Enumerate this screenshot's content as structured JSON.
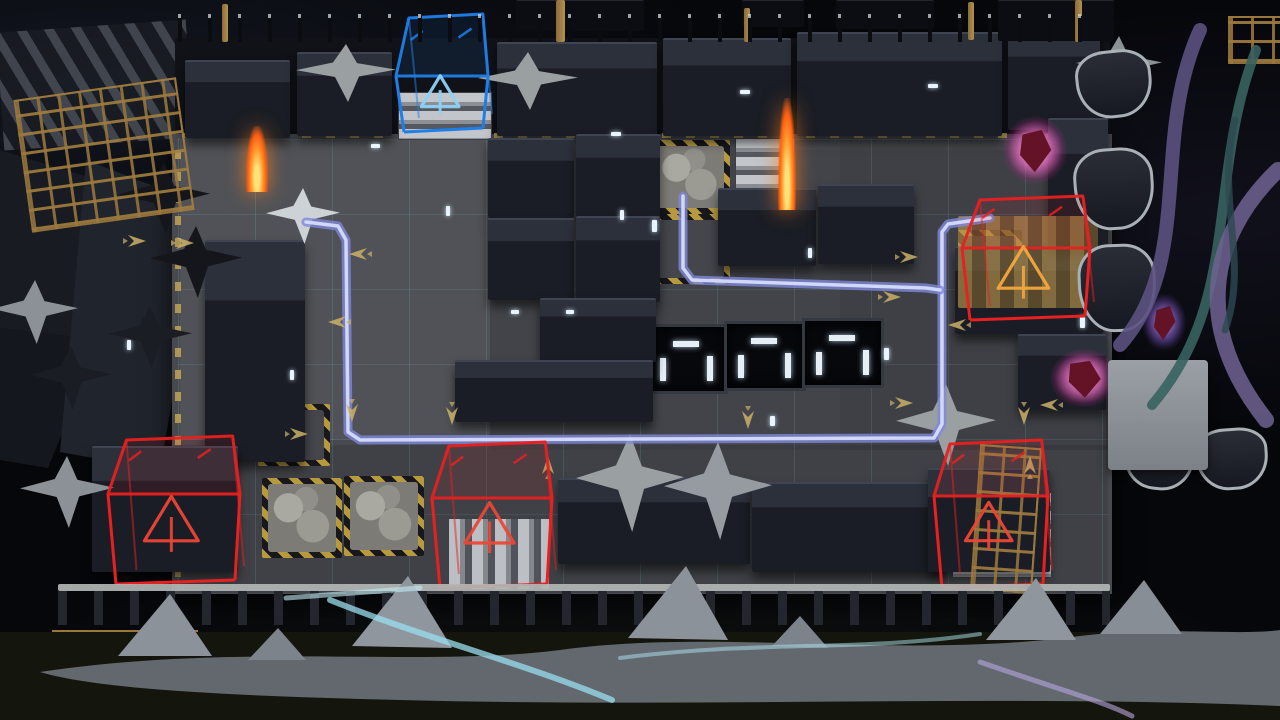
{
  "scene": {
    "description": "Tower-defense naval deck map preview with enemy spawn boxes, defense point and enemy route lines",
    "canvas": {
      "w": 1280,
      "h": 720
    }
  },
  "palette": {
    "water": "#06070b",
    "deck": "#47494f",
    "block_top": "#2c303b",
    "route_outer": "#7f88d8",
    "route_inner": "#d6dcfa",
    "spawn_red": "#e82020",
    "objective_blue": "#1f7fe8",
    "objective_icon": "#8fd2f8",
    "spawn_icon_orange": "#f2a83e",
    "spawn_icon_red": "#ee4636",
    "arrow_tan": "#cbb069",
    "hazard_yellow": "#b89a3e",
    "flame_orange": "#ff7a1a"
  },
  "board": {
    "x": 178,
    "y": 138,
    "w": 930,
    "h": 452,
    "cols": 12,
    "rows": 6
  },
  "objective": {
    "id": "defense-point",
    "x": 396,
    "y": 14,
    "w": 92,
    "h": 118,
    "th": 62,
    "color": "#1f7fe8",
    "icon_color": "#8fd2f8"
  },
  "spawns": [
    {
      "id": "spawn-northeast",
      "x": 962,
      "y": 196,
      "w": 128,
      "h": 124,
      "th": 52,
      "color": "#e82020",
      "icon_color": "#f2a83e"
    },
    {
      "id": "spawn-southwest",
      "x": 108,
      "y": 436,
      "w": 132,
      "h": 148,
      "th": 58,
      "color": "#e82020",
      "icon_color": "#ee4636"
    },
    {
      "id": "spawn-south",
      "x": 432,
      "y": 442,
      "w": 120,
      "h": 146,
      "th": 56,
      "color": "#e82020",
      "icon_color": "#ee4636"
    },
    {
      "id": "spawn-southeast",
      "x": 934,
      "y": 440,
      "w": 114,
      "h": 148,
      "th": 56,
      "color": "#e82020",
      "icon_color": "#ee4636"
    }
  ],
  "routes": [
    {
      "id": "route-main",
      "points": [
        [
          990,
          218
        ],
        [
          948,
          224
        ],
        [
          942,
          232
        ],
        [
          942,
          424
        ],
        [
          934,
          438
        ],
        [
          360,
          440
        ],
        [
          348,
          432
        ],
        [
          346,
          240
        ],
        [
          338,
          226
        ],
        [
          306,
          222
        ]
      ]
    },
    {
      "id": "route-branch",
      "points": [
        [
          683,
          196
        ],
        [
          683,
          268
        ],
        [
          692,
          280
        ],
        [
          926,
          288
        ],
        [
          940,
          290
        ]
      ]
    }
  ],
  "arrows": [
    [
      138,
      241,
      0
    ],
    [
      186,
      243,
      0
    ],
    [
      357,
      254,
      180
    ],
    [
      336,
      322,
      180
    ],
    [
      300,
      434,
      0
    ],
    [
      352,
      414,
      90
    ],
    [
      452,
      417,
      90
    ],
    [
      748,
      421,
      90
    ],
    [
      1024,
      417,
      90
    ],
    [
      548,
      464,
      -90
    ],
    [
      1030,
      464,
      -90
    ],
    [
      910,
      257,
      0
    ],
    [
      893,
      297,
      0
    ],
    [
      956,
      325,
      180
    ],
    [
      905,
      403,
      0
    ],
    [
      1048,
      405,
      180
    ]
  ],
  "blocks": [
    {
      "x": 185,
      "y": 60,
      "w": 105,
      "h": 76
    },
    {
      "x": 297,
      "y": 52,
      "w": 95,
      "h": 82
    },
    {
      "x": 497,
      "y": 42,
      "w": 160,
      "h": 92
    },
    {
      "x": 663,
      "y": 38,
      "w": 128,
      "h": 96
    },
    {
      "x": 797,
      "y": 32,
      "w": 205,
      "h": 102
    },
    {
      "x": 1008,
      "y": 28,
      "w": 92,
      "h": 100
    },
    {
      "x": 516,
      "y": 0,
      "w": 128,
      "h": 30,
      "s": "d2"
    },
    {
      "x": 742,
      "y": 0,
      "w": 62,
      "h": 26,
      "s": "d2"
    },
    {
      "x": 836,
      "y": 0,
      "w": 98,
      "h": 28,
      "s": "d2"
    },
    {
      "x": 998,
      "y": 0,
      "w": 116,
      "h": 40,
      "s": "d2"
    },
    {
      "x": 205,
      "y": 240,
      "w": 100,
      "h": 220
    },
    {
      "x": 488,
      "y": 138,
      "w": 86,
      "h": 78
    },
    {
      "x": 576,
      "y": 134,
      "w": 84,
      "h": 82
    },
    {
      "x": 488,
      "y": 218,
      "w": 86,
      "h": 80
    },
    {
      "x": 576,
      "y": 216,
      "w": 84,
      "h": 84
    },
    {
      "x": 718,
      "y": 188,
      "w": 98,
      "h": 76
    },
    {
      "x": 818,
      "y": 184,
      "w": 96,
      "h": 78
    },
    {
      "x": 540,
      "y": 298,
      "w": 116,
      "h": 62
    },
    {
      "x": 455,
      "y": 360,
      "w": 198,
      "h": 60
    },
    {
      "x": 955,
      "y": 246,
      "w": 148,
      "h": 86
    },
    {
      "x": 1018,
      "y": 334,
      "w": 88,
      "h": 74
    },
    {
      "x": 1048,
      "y": 118,
      "w": 60,
      "h": 128
    },
    {
      "x": 92,
      "y": 446,
      "w": 146,
      "h": 124
    },
    {
      "x": 558,
      "y": 478,
      "w": 192,
      "h": 84
    },
    {
      "x": 752,
      "y": 482,
      "w": 192,
      "h": 88
    },
    {
      "x": 928,
      "y": 468,
      "w": 122,
      "h": 102
    }
  ],
  "pits": [
    {
      "x": 646,
      "y": 324,
      "w": 76,
      "h": 64
    },
    {
      "x": 724,
      "y": 321,
      "w": 76,
      "h": 64
    },
    {
      "x": 802,
      "y": 318,
      "w": 76,
      "h": 64
    }
  ],
  "hazards_rubble": [
    {
      "x": 650,
      "y": 140,
      "w": 80,
      "h": 74
    },
    {
      "x": 262,
      "y": 478,
      "w": 80,
      "h": 80
    },
    {
      "x": 344,
      "y": 476,
      "w": 80,
      "h": 80
    }
  ],
  "hazards_outline": [
    {
      "x": 258,
      "y": 404,
      "w": 72,
      "h": 62
    },
    {
      "x": 652,
      "y": 214,
      "w": 78,
      "h": 70
    },
    {
      "x": 958,
      "y": 230,
      "w": 64,
      "h": 64
    }
  ],
  "stairs": [
    {
      "x": 398,
      "y": 92,
      "w": 92,
      "h": 46,
      "dir": "h"
    },
    {
      "x": 735,
      "y": 138,
      "w": 58,
      "h": 76,
      "dir": "h"
    },
    {
      "x": 448,
      "y": 518,
      "w": 100,
      "h": 70,
      "dir": "v"
    },
    {
      "x": 952,
      "y": 492,
      "w": 98,
      "h": 84,
      "dir": "h"
    },
    {
      "x": 150,
      "y": 472,
      "w": 82,
      "h": 96,
      "dir": "v"
    }
  ],
  "caltrops": [
    {
      "x": 296,
      "y": 44,
      "w": 100,
      "h": 58,
      "c": "#9aa0a2"
    },
    {
      "x": 478,
      "y": 52,
      "w": 100,
      "h": 58,
      "c": "#9aa0a2"
    },
    {
      "x": 266,
      "y": 188,
      "w": 74,
      "h": 56,
      "c": "#cdd2d6"
    },
    {
      "x": 576,
      "y": 434,
      "w": 108,
      "h": 98,
      "c": "#9aa0a2"
    },
    {
      "x": 664,
      "y": 442,
      "w": 108,
      "h": 98,
      "c": "#959ba0"
    },
    {
      "x": 896,
      "y": 384,
      "w": 100,
      "h": 82,
      "c": "#9aa0a2"
    },
    {
      "x": -8,
      "y": 280,
      "w": 86,
      "h": 64,
      "c": "#8b9196"
    },
    {
      "x": 20,
      "y": 456,
      "w": 94,
      "h": 72,
      "c": "#8b9196"
    },
    {
      "x": 1076,
      "y": 36,
      "w": 86,
      "h": 60,
      "c": "#8b9196"
    },
    {
      "x": 118,
      "y": 162,
      "w": 92,
      "h": 72,
      "c": "#14161c"
    },
    {
      "x": 150,
      "y": 226,
      "w": 92,
      "h": 72,
      "c": "#14161c"
    },
    {
      "x": 30,
      "y": 346,
      "w": 82,
      "h": 64,
      "c": "#1a1d23"
    },
    {
      "x": 108,
      "y": 306,
      "w": 84,
      "h": 62,
      "c": "#1a1d23"
    }
  ],
  "scaffolds": [
    {
      "x": 22,
      "y": 88,
      "w": 160,
      "h": 130,
      "rot": -8
    },
    {
      "x": 52,
      "y": 630,
      "w": 142,
      "h": 84,
      "rot": 0
    },
    {
      "x": 975,
      "y": 446,
      "w": 58,
      "h": 142,
      "rot": 4
    },
    {
      "x": 1228,
      "y": 16,
      "w": 52,
      "h": 44,
      "rot": 0
    }
  ],
  "planks": [
    {
      "x": 958,
      "y": 216,
      "w": 140,
      "h": 92
    }
  ],
  "pods": [
    {
      "x": 1076,
      "y": 50,
      "w": 70,
      "h": 62,
      "rot": -6
    },
    {
      "x": 1074,
      "y": 148,
      "w": 74,
      "h": 76,
      "rot": -4
    },
    {
      "x": 1078,
      "y": 244,
      "w": 72,
      "h": 82,
      "rot": -2
    },
    {
      "x": 1124,
      "y": 430,
      "w": 64,
      "h": 54,
      "rot": 6
    },
    {
      "x": 1196,
      "y": 428,
      "w": 66,
      "h": 56,
      "rot": -4
    }
  ],
  "masts": [
    {
      "x": 222,
      "y": 4,
      "w": 6,
      "h": 38
    },
    {
      "x": 556,
      "y": 0,
      "w": 9,
      "h": 42
    },
    {
      "x": 744,
      "y": 8,
      "w": 6,
      "h": 34
    },
    {
      "x": 968,
      "y": 2,
      "w": 6,
      "h": 38
    },
    {
      "x": 1075,
      "y": 0,
      "w": 7,
      "h": 42
    }
  ],
  "flames": [
    {
      "x": 246,
      "y": 126,
      "w": 22,
      "h": 66
    },
    {
      "x": 778,
      "y": 98,
      "w": 18,
      "h": 112
    }
  ],
  "crystals": [
    {
      "x": 993,
      "y": 106,
      "w": 84,
      "h": 88,
      "kind": "pink"
    },
    {
      "x": 1040,
      "y": 340,
      "w": 88,
      "h": 76,
      "kind": "pink"
    },
    {
      "x": 1136,
      "y": 286,
      "w": 56,
      "h": 72,
      "kind": "purple"
    }
  ],
  "leds": [
    [
      371,
      144,
      9,
      4
    ],
    [
      620,
      210,
      4,
      10
    ],
    [
      511,
      310,
      8,
      4
    ],
    [
      566,
      310,
      8,
      4
    ],
    [
      290,
      370,
      4,
      10
    ],
    [
      652,
      220,
      5,
      12
    ],
    [
      884,
      348,
      5,
      12
    ],
    [
      1080,
      316,
      5,
      12
    ],
    [
      770,
      416,
      5,
      10
    ],
    [
      127,
      340,
      4,
      10
    ],
    [
      740,
      90,
      10,
      4
    ],
    [
      928,
      84,
      10,
      4
    ],
    [
      611,
      132,
      10,
      4
    ],
    [
      446,
      206,
      4,
      10
    ],
    [
      808,
      248,
      4,
      10
    ]
  ],
  "tints": [
    {
      "x": 180,
      "y": 140,
      "w": 310,
      "h": 300,
      "c": "rgba(255,255,255,0.05)"
    },
    {
      "x": 490,
      "y": 150,
      "w": 618,
      "h": 300,
      "c": "rgba(0,0,0,0.06)"
    },
    {
      "x": 180,
      "y": 445,
      "w": 928,
      "h": 148,
      "c": "rgba(0,0,0,0.10)"
    },
    {
      "x": 840,
      "y": 140,
      "w": 268,
      "h": 310,
      "c": "rgba(0,0,0,0.05)"
    }
  ]
}
